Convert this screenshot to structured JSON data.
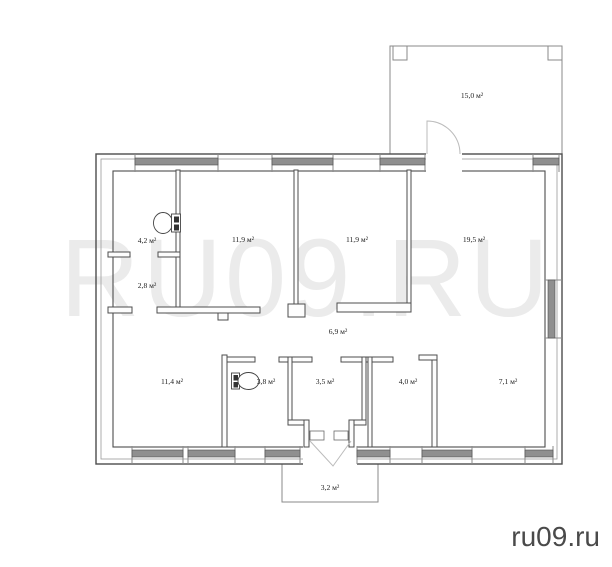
{
  "watermark": {
    "text": "RU09.RU"
  },
  "footer": {
    "site_label": "ru09.ru"
  },
  "plan": {
    "rooms": {
      "terrace": {
        "area": "15,0 м²"
      },
      "wc_top": {
        "area": "4,2 м²"
      },
      "hall_small": {
        "area": "2,8 м²"
      },
      "room_left": {
        "area": "11,9 м²"
      },
      "room_middle": {
        "area": "11,9 м²"
      },
      "room_right": {
        "area": "19,5 м²"
      },
      "hallway": {
        "area": "6,9 м²"
      },
      "room_bottom_left": {
        "area": "11,4 м²"
      },
      "wc_bottom": {
        "area": "3,8 м²"
      },
      "vestibule": {
        "area": "3,5 м²"
      },
      "room_bottom_mid": {
        "area": "4,0 м²"
      },
      "room_bottom_right": {
        "area": "7,1 м²"
      },
      "porch": {
        "area": "3,2 м²"
      }
    },
    "icons": [
      {
        "name": "toilet-icon",
        "room": "wc_top"
      },
      {
        "name": "toilet-icon",
        "room": "wc_bottom"
      }
    ],
    "colors": {
      "wall_line": "#4d4d4d",
      "window_sill": "#8f8f8f",
      "watermark": "#ebebeb",
      "footer_text": "#4a4a4a"
    }
  }
}
